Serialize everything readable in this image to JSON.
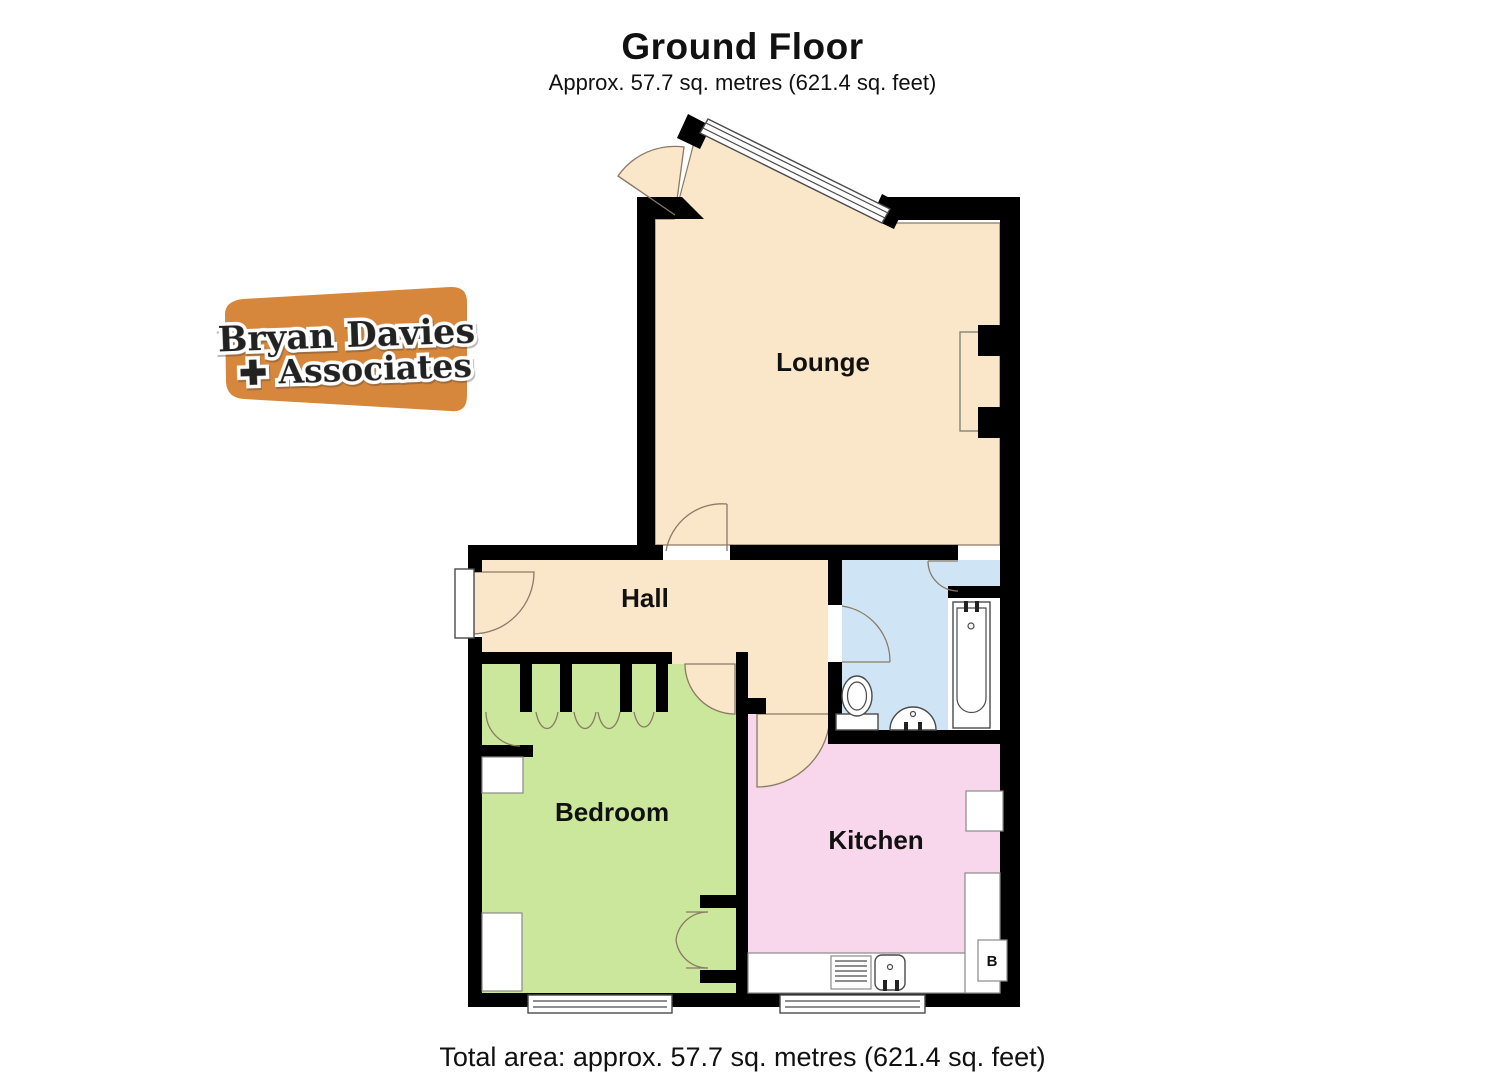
{
  "header": {
    "title": "Ground Floor",
    "subtitle": "Approx. 57.7 sq. metres (621.4 sq. feet)"
  },
  "footer": {
    "total_area": "Total area: approx. 57.7 sq. metres (621.4 sq. feet)"
  },
  "logo": {
    "line1": "Bryan Davies",
    "line2": "✚ Associates",
    "bg_color": "#d6873b"
  },
  "rooms": {
    "lounge": {
      "label": "Lounge",
      "color": "#fae6c8"
    },
    "hall": {
      "label": "Hall",
      "color": "#fae6c8"
    },
    "bedroom": {
      "label": "Bedroom",
      "color": "#cbe79b"
    },
    "kitchen": {
      "label": "Kitchen",
      "color": "#f8d7ec"
    },
    "bathroom": {
      "color": "#cfe5f6"
    }
  },
  "annotations": {
    "boiler": "B"
  },
  "colors": {
    "walls": "#000000",
    "door_arc": "#8a7a66",
    "fixture_outline": "#4a4a4a"
  }
}
